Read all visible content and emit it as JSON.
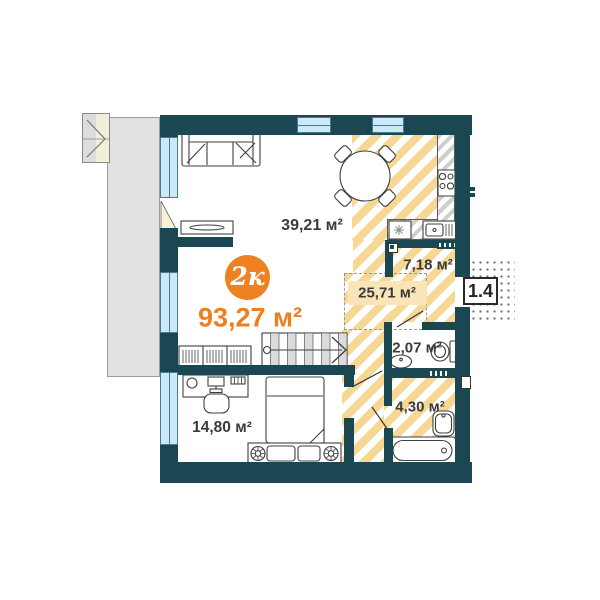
{
  "plan": {
    "badge": {
      "label": "2к",
      "total_area": "93,27 м²"
    },
    "unit_number": "1.4",
    "areas": {
      "living": "39,21 м²",
      "kitchen_zone": "25,71 м²",
      "hallway": "7,18 м²",
      "wc": "2,07 м²",
      "bathroom": "4,30 м²",
      "bedroom": "14,80 м²"
    },
    "furniture_symbols": [
      "sofa",
      "tv-stand",
      "dining-table",
      "kitchen-counter",
      "stove",
      "kitchen-sink",
      "hob-asterisk",
      "stairs",
      "wardrobe",
      "desk",
      "office-chair",
      "bed",
      "nightstand-flowers",
      "toilet",
      "wc-sink",
      "bath-sink",
      "bathtub",
      "balcony-door",
      "entrance-landing"
    ],
    "colors": {
      "wall": "#1B4752",
      "accent_orange": "#EE8121",
      "hatch_yellow": "#F6D794",
      "window_blue": "#CBE9F6",
      "terrace_gray": "#E2E2E2",
      "label_text": "#3A3A3A",
      "band_cream": "#FAE5B8"
    }
  }
}
